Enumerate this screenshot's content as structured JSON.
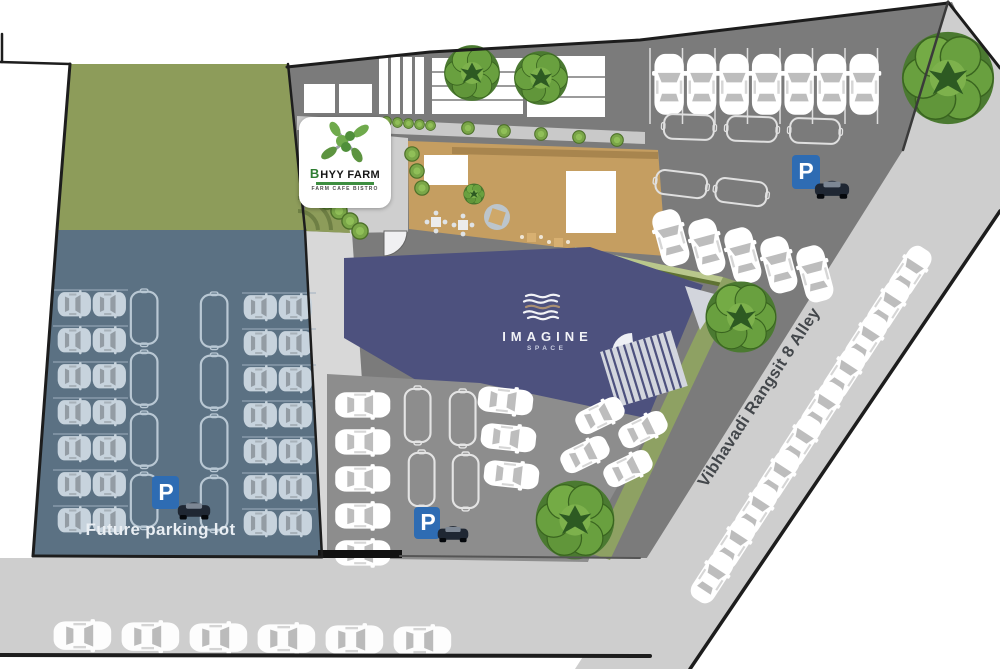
{
  "meta": {
    "title": "Imagine Space / BHYY Farm site plan"
  },
  "labels": {
    "future_parking_lot": "Future parking lot",
    "street_name": "Vibhavadi Rangsit 8 Alley",
    "parking_sign": "P"
  },
  "logos": {
    "bhyy_farm": {
      "prefix": "B",
      "name": "HYY FARM",
      "tagline": "FARM CAFE BISTRO"
    },
    "imagine_space": {
      "name": "IMAGINE",
      "sub": "SPACE"
    }
  },
  "icons": {
    "parking_sign": "blue square with white letter P and dark car glyph",
    "tree": "round layered green canopy",
    "car": "white top-view car",
    "empty_spot": "outlined parking spot"
  },
  "colors": {
    "building_roof": "#4d517e",
    "future_lot": "#5b7183",
    "lawn": "#8d9c5a",
    "site_ground": "#7b7b7b",
    "road": "#cecece",
    "deck": "#c59e61",
    "parking_sign_blue": "#2e6cb3"
  }
}
